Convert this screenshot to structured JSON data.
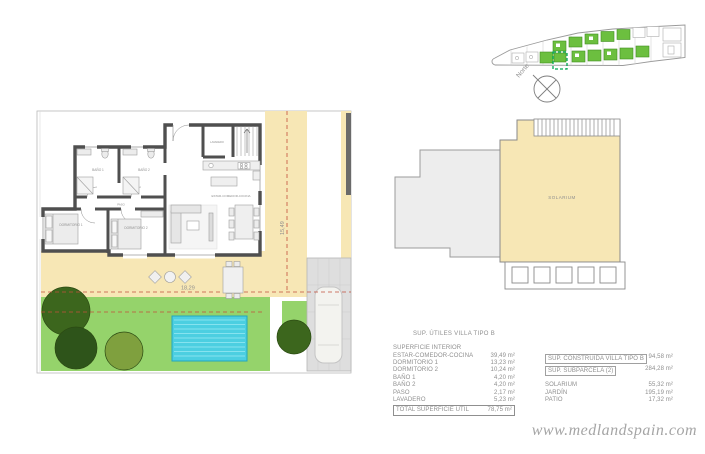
{
  "meta": {
    "watermark": "www.medlandspain.com"
  },
  "site_plan": {
    "north_label": "Norte"
  },
  "floor_plan": {
    "dim_width": "18,29",
    "dim_height": "15,49",
    "rooms": {
      "living": "ESTAR-COMEDOR-COCINA",
      "bedroom1": "DORMITORIO 1",
      "bedroom2": "DORMITORIO 2",
      "bath1": "BAÑO 1",
      "bath2": "BAÑO 2",
      "hall": "PASO",
      "laundry": "LAVADERO"
    }
  },
  "roof_plan": {
    "solarium": "SOLARIUM"
  },
  "areas_table": {
    "title": "SUP. ÚTILES VILLA TIPO B",
    "header": "SUPERFICIE INTERIOR",
    "rows": [
      {
        "label": "ESTAR-COMEDOR-COCINA",
        "value": "39,49 m²"
      },
      {
        "label": "DORMITORIO 1",
        "value": "13,23 m²"
      },
      {
        "label": "DORMITORIO 2",
        "value": "10,24 m²"
      },
      {
        "label": "BAÑO 1",
        "value": "4,20 m²"
      },
      {
        "label": "BAÑO 2",
        "value": "4,20 m²"
      },
      {
        "label": "PASO",
        "value": "2,17 m²"
      },
      {
        "label": "LAVADERO",
        "value": "5,23 m²"
      }
    ],
    "total": {
      "label": "TOTAL SUPERFICIE ÚTIL",
      "value": "78,75 m²"
    }
  },
  "summary_table": {
    "rows_boxed": [
      {
        "label": "SUP. CONSTRUIDA VILLA TIPO B",
        "value": "94,58 m²"
      },
      {
        "label": "SUP. SUBPARCELA (2)",
        "value": "284,28 m²"
      }
    ],
    "rows": [
      {
        "label": "SOLARIUM",
        "value": "55,32 m²"
      },
      {
        "label": "JARDÍN",
        "value": "195,19 m²"
      },
      {
        "label": "PATIO",
        "value": "17,32 m²"
      }
    ]
  },
  "colors": {
    "terrace": "#f7e7b5",
    "garden": "#95d36b",
    "pool": "#4ccfe1",
    "dimension_red": "#c1503c",
    "site_unit_green": "#6cbf3f",
    "selected_unit_green": "#00a651",
    "wall": "#4f4f4f"
  }
}
